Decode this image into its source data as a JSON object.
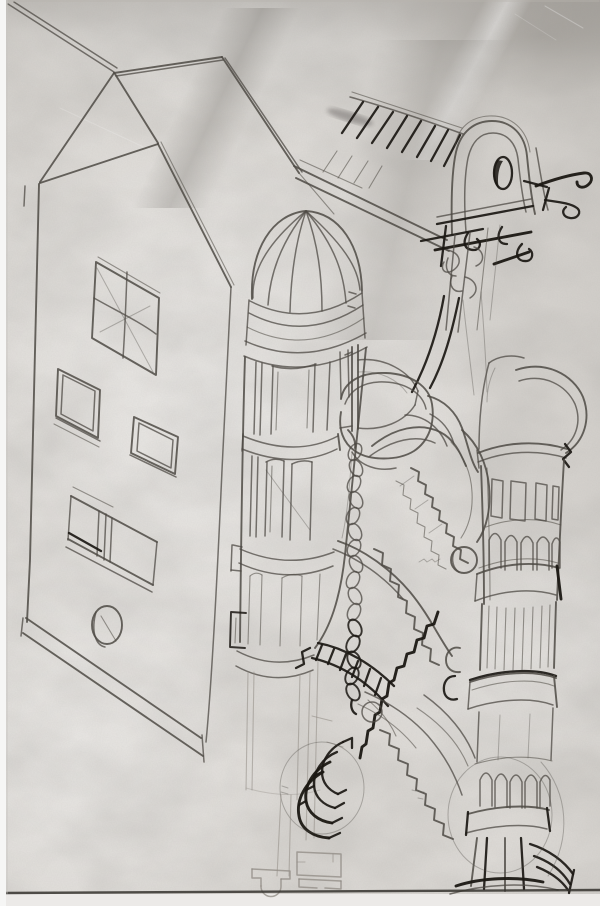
{
  "scene": {
    "kind": "hand-drawn architectural concept sketch, graphite pencil and ink on creased paper",
    "elements": [
      "hip-roofed building with paned windows and porthole",
      "ribbed-dome stair tower with belted cylindrical shaft",
      "twisted rope hanging beside the dome tower",
      "arch-headed viaduct structure with oval opening, hatched roof and ink hooks",
      "serpentine cascading staircase with zigzag steps and newel ball",
      "round tower with window tier, arcades, belts, fluting and flared base",
      "spiral stair base with fanned treads",
      "faint plan sketch near the bottom edge"
    ]
  },
  "colors": {
    "paper": "#dcd9d5",
    "pencil": "#4e4a44",
    "pencil_faint": "#8f8a83",
    "ink": "#1b1813",
    "highlight": "#ffffff",
    "bottom_edge": "#35322e",
    "scan_background": "#f7f7f6"
  }
}
